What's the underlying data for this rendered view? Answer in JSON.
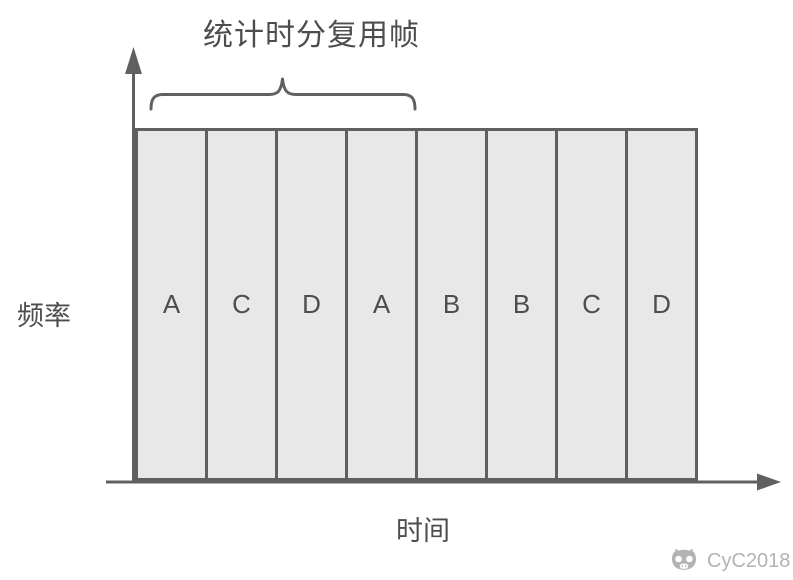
{
  "title": "统计时分复用帧",
  "axes": {
    "y_label": "频率",
    "x_label": "时间"
  },
  "slots": [
    "A",
    "C",
    "D",
    "A",
    "B",
    "B",
    "C",
    "D"
  ],
  "brace": {
    "covers_slot_count": 4
  },
  "watermark": {
    "text": "CyC2018",
    "logo": "cat-logo"
  },
  "icons": {
    "y_axis_arrow": "up-arrow",
    "x_axis_arrow": "right-arrow",
    "grouping": "curly-brace"
  },
  "colors": {
    "border": "#606060",
    "fill": "#e8e8e8",
    "text": "#4d4d4d",
    "watermark": "#b3b3b3",
    "bg": "#ffffff"
  }
}
